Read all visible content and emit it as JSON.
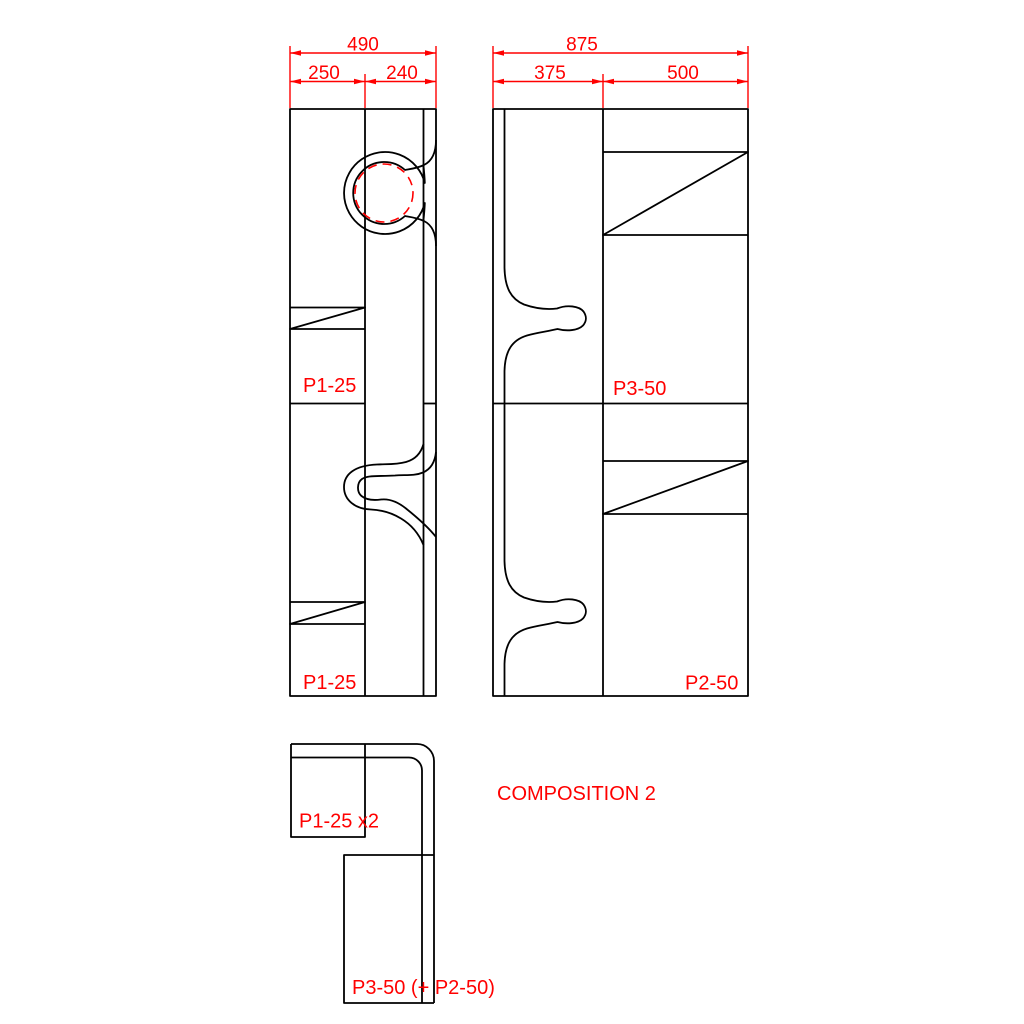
{
  "drawing": {
    "caption": "COMPOSITION 2",
    "front_view": {
      "dim_overall": "490",
      "dim_left": "250",
      "dim_right": "240",
      "label_upper": "P1-25",
      "label_lower": "P1-25"
    },
    "side_view": {
      "dim_overall": "875",
      "dim_left": "375",
      "dim_right": "500",
      "label_upper": "P3-50",
      "label_lower": "P2-50"
    },
    "composition_view": {
      "label_panels": "P1-25 x2",
      "label_back": "P3-50 (+ P2-50)"
    },
    "colors": {
      "dimension": "#ff0000",
      "outline": "#000000",
      "background": "#ffffff"
    }
  }
}
